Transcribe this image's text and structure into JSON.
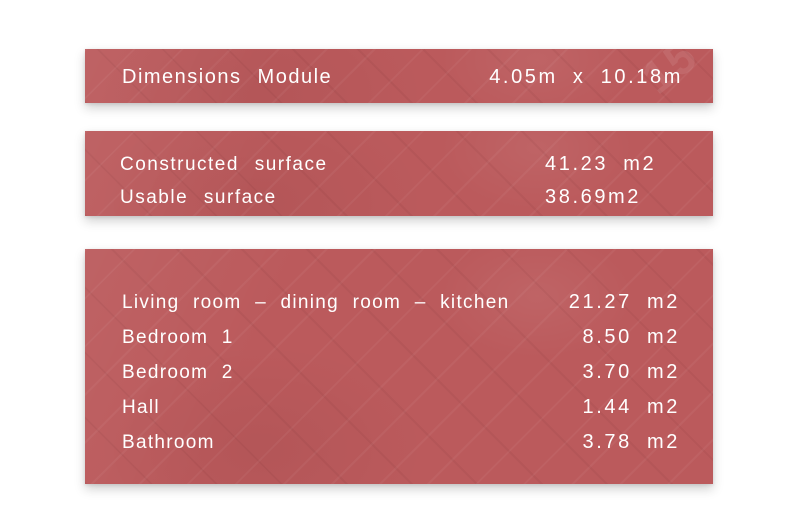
{
  "theme": {
    "panel_color": "#bb5a5c",
    "text_color": "#ffffff",
    "page_background": "#ffffff"
  },
  "dimensions_panel": {
    "title": "Dimensions Module",
    "value": "4.05m x 10.18m"
  },
  "surface_panel": {
    "rows": [
      {
        "label": "Constructed surface",
        "value": "41.23 m2"
      },
      {
        "label": "Usable surface",
        "value": "38.69m2"
      }
    ]
  },
  "rooms_panel": {
    "rows": [
      {
        "label": "Living room – dining room – kitchen",
        "value": "21.27 m2"
      },
      {
        "label": "Bedroom 1",
        "value": "8.50 m2"
      },
      {
        "label": "Bedroom 2",
        "value": "3.70 m2"
      },
      {
        "label": "Hall",
        "value": "1.44 m2"
      },
      {
        "label": "Bathroom",
        "value": "3.78 m2"
      }
    ]
  },
  "decor": {
    "watermark": "15"
  }
}
